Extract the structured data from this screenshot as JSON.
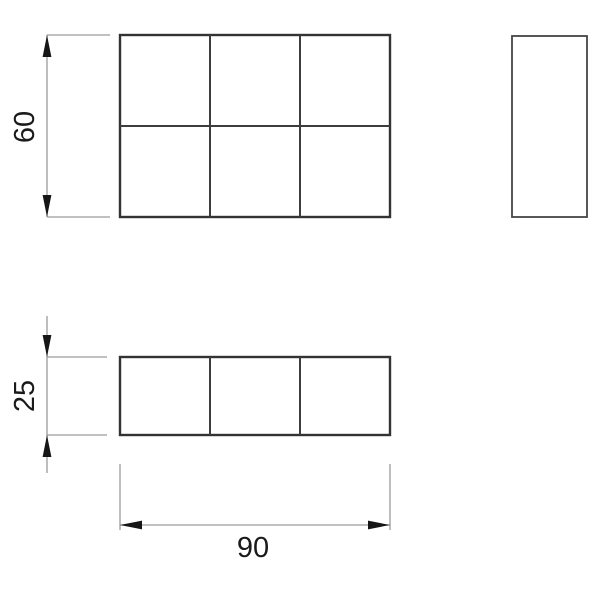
{
  "dimensions": {
    "height_label": "60",
    "depth_label": "25",
    "width_label": "90"
  },
  "colors": {
    "background": "#ffffff",
    "outline": "#333333",
    "inner_line": "#3d3d3d",
    "side_outline": "#454545",
    "dimension_line": "#9a9a9a",
    "arrow": "#161616",
    "text": "#1a1a1a"
  }
}
